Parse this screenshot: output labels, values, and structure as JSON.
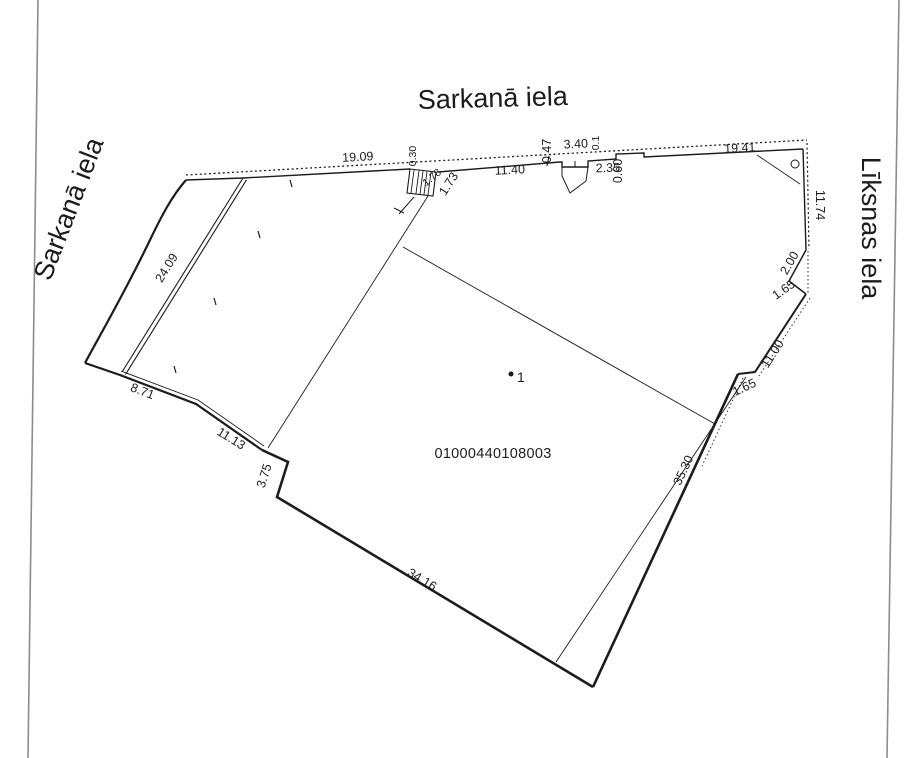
{
  "drawing": {
    "street_top": "Sarkanā iela",
    "street_left": "Sarkanā iela",
    "street_right": "Līksnas iela",
    "cadastral_number": "01000440108003",
    "point_label": "1",
    "dims": {
      "top_19_09": "19.09",
      "top_0_30": "0.30",
      "top_1_78": "1.78",
      "top_1_73": "1.73",
      "top_11_40": "11.40",
      "top_0_47": "0.47",
      "top_3_40": "3.40",
      "top_0_1": "0.1",
      "top_2_35": "2.35",
      "top_0_60": "0.60",
      "top_19_41": "19.41",
      "right_11_74": "11.74",
      "right_2_00": "2.00",
      "right_1_65_notch": "1.65",
      "right_11_00": "11.00",
      "right_1_65_step": "1.65",
      "right_35_30": "35.30",
      "bottom_34_16": "34.16",
      "bottom_3_75": "3.75",
      "bottom_11_13": "11.13",
      "bottom_8_71": "8.71",
      "strip_24_09": "24.09"
    },
    "colors": {
      "ink": "#1c1c1c",
      "page_edge": "#8c8c8c"
    }
  }
}
